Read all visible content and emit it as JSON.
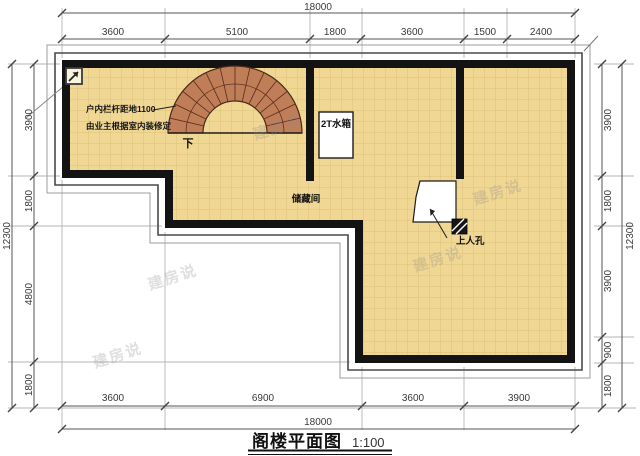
{
  "title": {
    "name": "阁楼平面图",
    "scale": "1:100"
  },
  "plan": {
    "labels": {
      "water_tank": "2T水箱",
      "storage": "储藏间",
      "manhole": "上人孔",
      "stair_down": "下"
    },
    "note": {
      "line1": "户内栏杆距地1100",
      "line2": "由业主根据室内装修定"
    }
  },
  "dimensions": {
    "top": {
      "overall": "18000",
      "segments": [
        "3600",
        "5100",
        "1800",
        "3600",
        "1500",
        "2400"
      ]
    },
    "bottom": {
      "overall": "18000",
      "segments": [
        "3600",
        "6900",
        "3600",
        "3900"
      ]
    },
    "left": {
      "overall": "12300",
      "segments": [
        "3900",
        "1800",
        "4800",
        "1800"
      ]
    },
    "right": {
      "overall": "12300",
      "segments": [
        "3900",
        "1800",
        "3900",
        "900",
        "1800"
      ]
    }
  },
  "watermark": {
    "text": "建房说"
  },
  "colors": {
    "floor": "#f1d794",
    "tile_line": "#dcc077",
    "wall": "#131313",
    "stair": "#c07e58",
    "stair_line": "#5f3222",
    "dim_line": "#555555",
    "outline_inner": "#4a4a4a",
    "outline_outer": "#9c9c9c"
  }
}
